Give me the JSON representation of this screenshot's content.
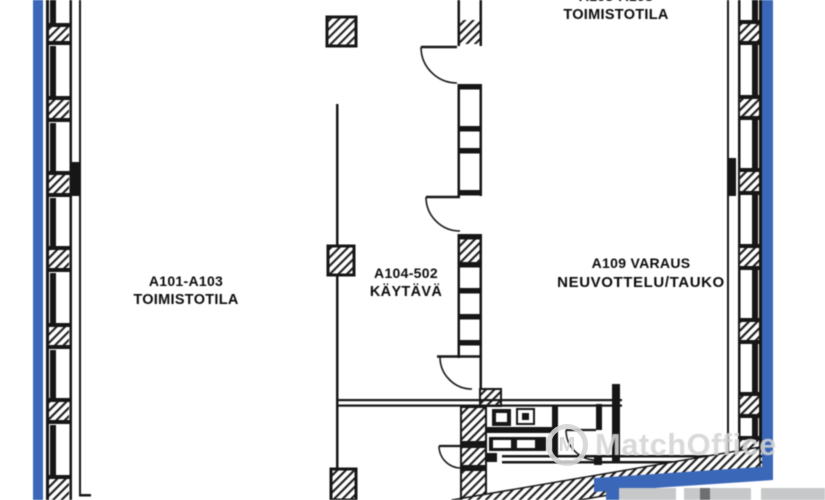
{
  "plan": {
    "type": "floor-plan",
    "rooms": {
      "left_office": {
        "line1": "A101-A103",
        "line2": "TOIMISTOTILA"
      },
      "corridor": {
        "line1": "A104-502",
        "line2": "KÄYTÄVÄ"
      },
      "top_office": {
        "line1": "A105-A108",
        "line2": "TOIMISTOTILA"
      },
      "meeting_room": {
        "line1": "A109 VARAUS",
        "line2": "NEUVOTTELU/TAUKO"
      }
    },
    "watermark": {
      "text": "MatchOffice",
      "logo_letter": "M"
    },
    "colors": {
      "outline_blue": "#3a67b7",
      "line_black": "#161616",
      "watermark_gray": "#d4d4d4",
      "adjacent_gray": "#c6c8ca",
      "adjacent_dark": "#6d7072"
    }
  }
}
